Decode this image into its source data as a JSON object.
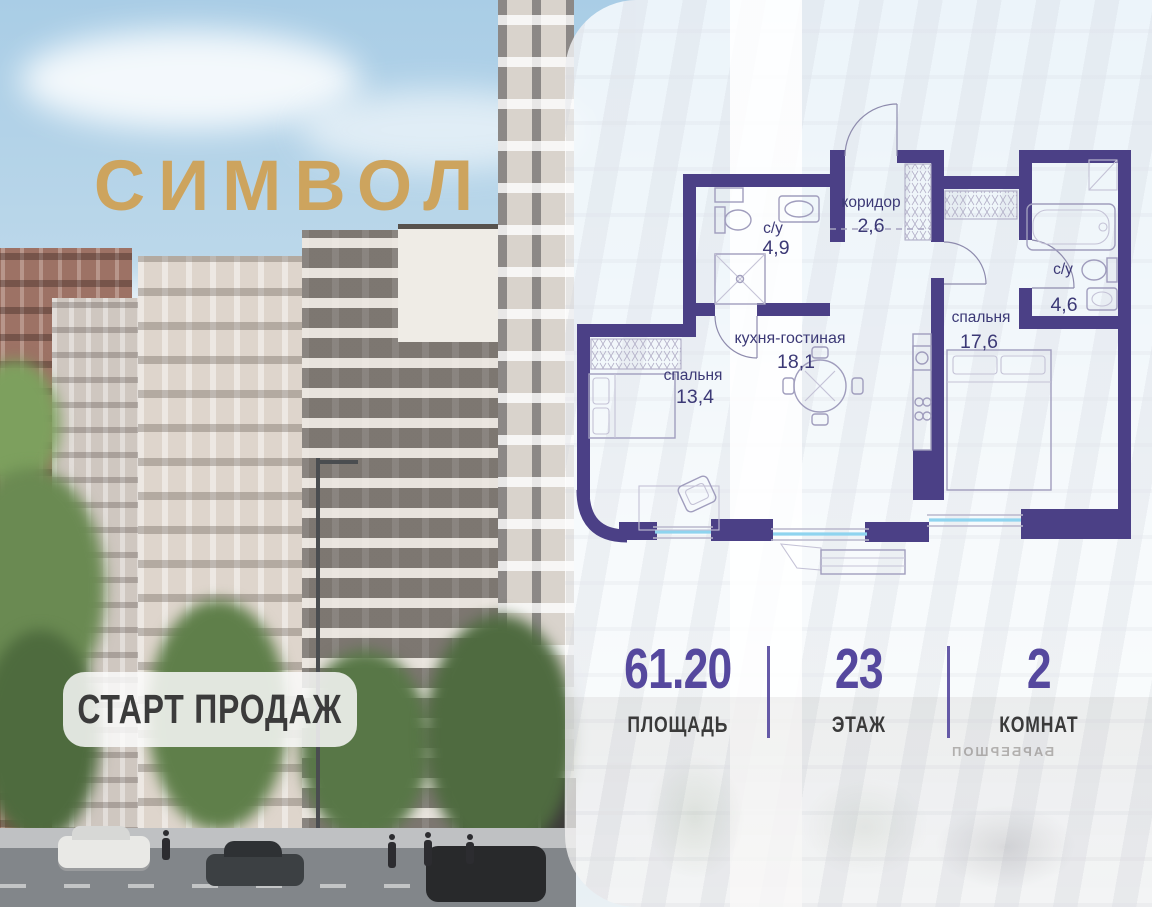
{
  "brand": {
    "logo_text": "СИМВОЛ"
  },
  "badge": {
    "label": "СТАРТ ПРОДАЖ"
  },
  "panel": {
    "background_sign": "БАРБЕРШОП"
  },
  "floor_plan": {
    "rooms": {
      "corridor": {
        "name": "коридор",
        "area": "2,6"
      },
      "bathroom_1": {
        "name": "с/у",
        "area": "4,9"
      },
      "kitchen_living": {
        "name": "кухня-гостиная",
        "area": "18,1"
      },
      "bedroom_1": {
        "name": "спальня",
        "area": "13,4"
      },
      "bedroom_2": {
        "name": "спальня",
        "area": "17,6"
      },
      "bathroom_2": {
        "name": "с/у",
        "area": "4,6"
      }
    }
  },
  "stats": [
    {
      "value": "61.20",
      "label": "ПЛОЩАДЬ"
    },
    {
      "value": "23",
      "label": "ЭТАЖ"
    },
    {
      "value": "2",
      "label": "КОМНАТ"
    }
  ],
  "colors": {
    "wall": "#4B4086",
    "logo_gold": "#CDA45E",
    "stat_number": "#55489E",
    "window_glass": "#8FD4EF"
  }
}
